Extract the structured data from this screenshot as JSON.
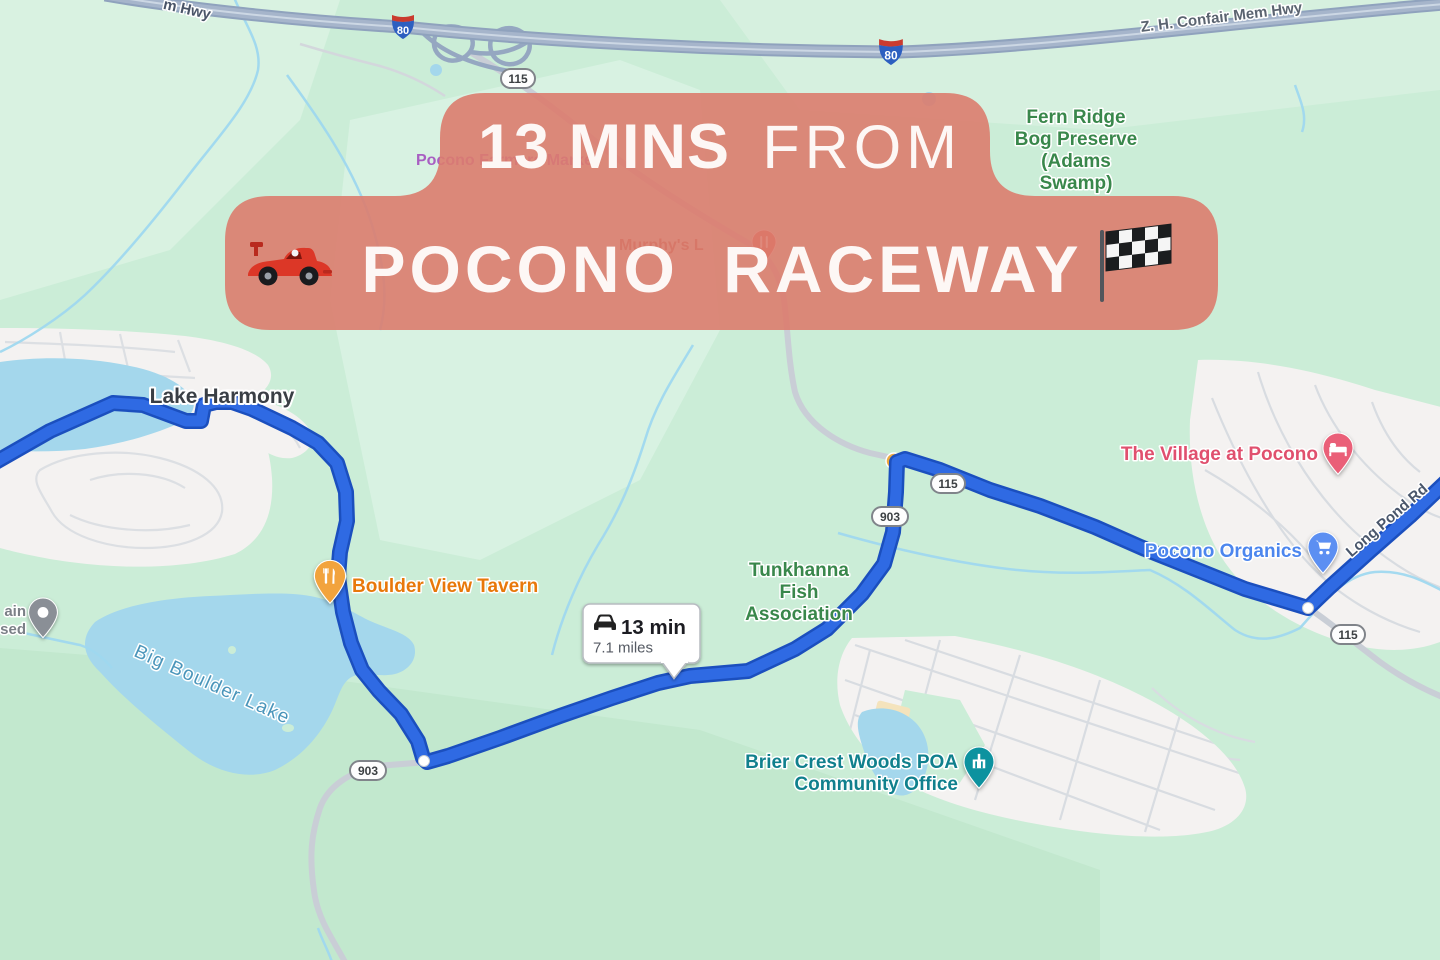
{
  "banner": {
    "duration_highlight": "13 MINS",
    "connector": "FROM",
    "destination": "POCONO RACEWAY",
    "left_icon": "racing-car-icon",
    "right_icon": "checkered-flag-icon",
    "bg_color": "#DB7C6E"
  },
  "route_bubble": {
    "duration": "13 min",
    "distance": "7.1 miles",
    "icon": "car-icon"
  },
  "shields": {
    "interstate_80": "80",
    "route_115": "115",
    "route_903": "903"
  },
  "labels": {
    "lake_harmony": "Lake Harmony",
    "fern_ridge": [
      "Fern Ridge",
      "Bog Preserve",
      "(Adams",
      "Swamp)"
    ],
    "tunkhanna": [
      "Tunkhanna",
      "Fish",
      "Association"
    ],
    "brier_crest": [
      "Brier Crest Woods POA",
      "Community Office"
    ],
    "boulder_view_tavern": "Boulder View Tavern",
    "big_boulder_lake": "Big Boulder Lake",
    "village_at_pocono": "The Village at Pocono",
    "pocono_organics": "Pocono Organics",
    "confair_hwy": "Z. H. Confair Mem Hwy",
    "hwy_fragment": "m Hwy",
    "long_pond_rd": "Long Pond Rd",
    "murphys_fragment": "Murphy's L",
    "farmers_market": "Pocono Farmers Market",
    "poi_fragment_line1": "ain",
    "poi_fragment_line2": "sed"
  },
  "colors": {
    "banner": "#DB7C6E",
    "route_blue": "#2F6AE3",
    "water": "#A4D7EC",
    "land": "#CBEDD7",
    "park_label_green": "#39874B",
    "restaurant_orange": "#E8780A",
    "lodging_pink": "#E0506E",
    "shopping_blue": "#4C86EE",
    "office_teal": "#10808D"
  }
}
